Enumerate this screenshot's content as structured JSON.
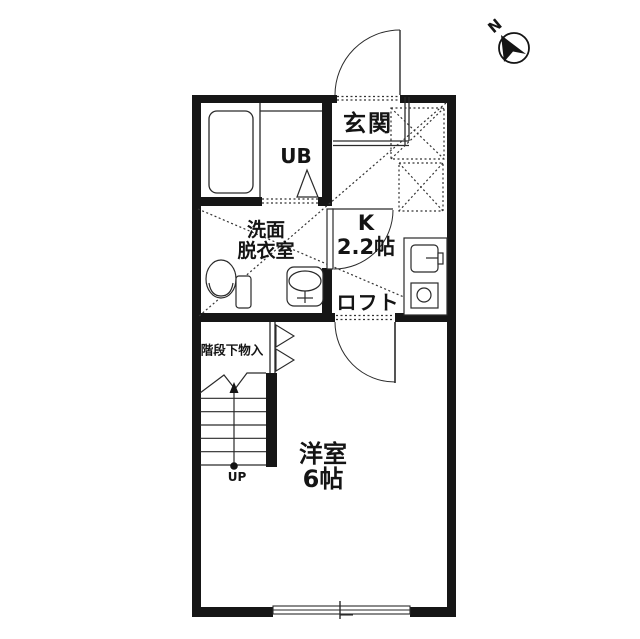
{
  "compass": {
    "north_label": "N"
  },
  "labels": {
    "entrance": "玄関",
    "unit_bath": "UB",
    "washroom_line1": "洗面",
    "washroom_line2": "脱衣室",
    "kitchen_type": "K",
    "kitchen_size": "2.2帖",
    "loft": "ロフト",
    "under_stair_storage": "階段下物入",
    "stairs_direction": "UP",
    "western_room": "洋室",
    "western_room_size": "6帖"
  },
  "colors": {
    "wall": "#161616",
    "line": "#2a2a2a",
    "background": "#ffffff"
  }
}
